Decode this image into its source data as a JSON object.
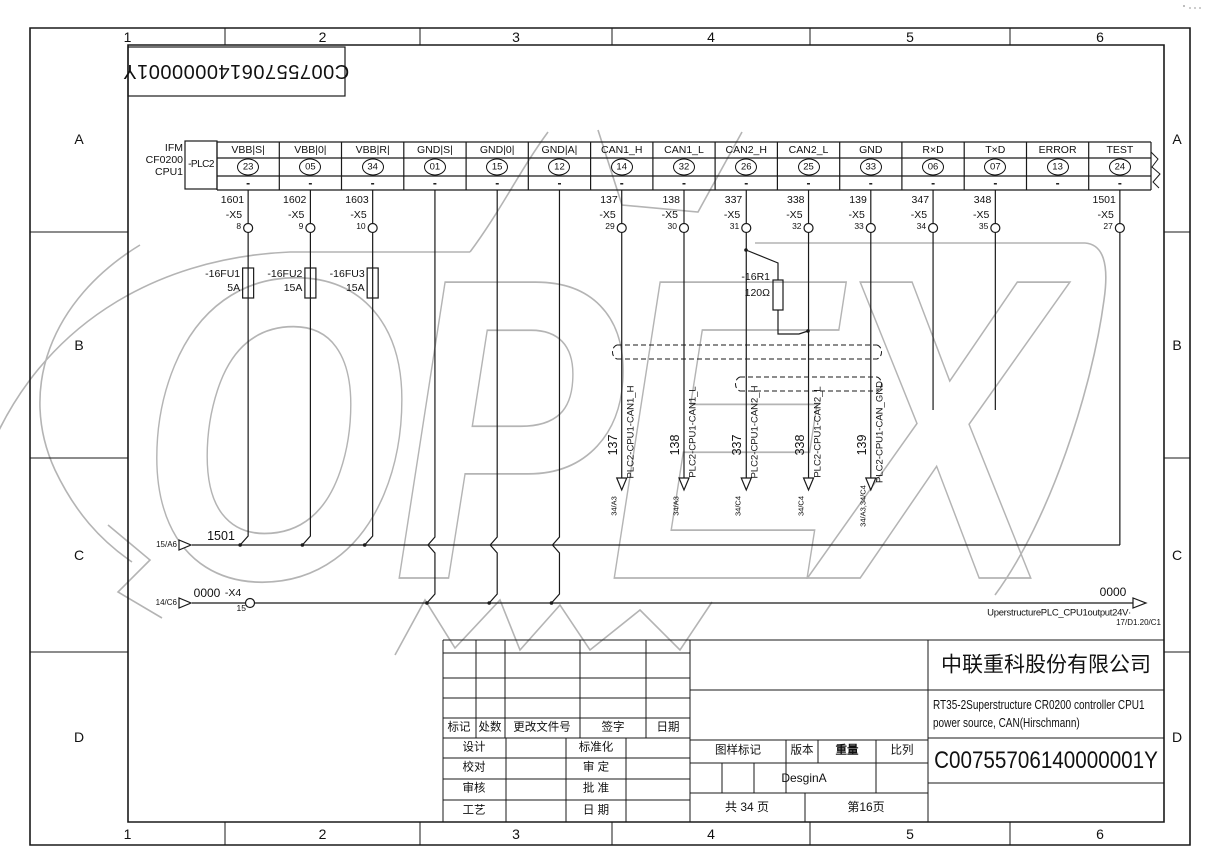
{
  "watermark": {
    "text": "OPEX"
  },
  "frame": {
    "columns": [
      "1",
      "2",
      "3",
      "4",
      "5",
      "6"
    ],
    "rows": [
      "A",
      "B",
      "C",
      "D"
    ]
  },
  "code_box": {
    "text": "C00755706140000001Y"
  },
  "plc": {
    "device_lines": [
      "IFM",
      "CF0200",
      "CPU1"
    ],
    "tag": "-PLC2",
    "connector_tag": "-X5",
    "terminal_dash": "-",
    "terminals": [
      {
        "label": "VBB|S|",
        "pin": "23",
        "wire": "1601",
        "x5_pin": "8",
        "fuse_tag": "-16FU1",
        "fuse_rating": "5A",
        "dest": "bus1501"
      },
      {
        "label": "VBB|0|",
        "pin": "05",
        "wire": "1602",
        "x5_pin": "9",
        "fuse_tag": "-16FU2",
        "fuse_rating": "15A",
        "dest": "bus1501"
      },
      {
        "label": "VBB|R|",
        "pin": "34",
        "wire": "1603",
        "x5_pin": "10",
        "fuse_tag": "-16FU3",
        "fuse_rating": "15A",
        "dest": "bus1501"
      },
      {
        "label": "GND|S|",
        "pin": "01",
        "dest": "bus0000"
      },
      {
        "label": "GND|0|",
        "pin": "15",
        "dest": "bus0000"
      },
      {
        "label": "GND|A|",
        "pin": "12",
        "dest": "bus0000"
      },
      {
        "label": "CAN1_H",
        "pin": "14",
        "wire": "137",
        "x5_pin": "29",
        "signal": "PLC2-CPU1-CAN1_H",
        "ref": "34/A3",
        "dest": "arrow"
      },
      {
        "label": "CAN1_L",
        "pin": "32",
        "wire": "138",
        "x5_pin": "30",
        "signal": "PLC2-CPU1-CAN1_L",
        "ref": "34/A3",
        "dest": "arrow"
      },
      {
        "label": "CAN2_H",
        "pin": "26",
        "wire": "337",
        "x5_pin": "31",
        "signal": "PLC2-CPU1-CAN2_H",
        "ref": "34/C4",
        "dest": "arrow"
      },
      {
        "label": "CAN2_L",
        "pin": "25",
        "wire": "338",
        "x5_pin": "32",
        "signal": "PLC2-CPU1-CAN2_L",
        "ref": "34/C4",
        "dest": "arrow"
      },
      {
        "label": "GND",
        "pin": "33",
        "wire": "139",
        "x5_pin": "33",
        "signal": "PLC2-CPU1-CAN_GND",
        "ref": "34/A3,34/C4",
        "dest": "arrow"
      },
      {
        "label": "R×D",
        "pin": "06",
        "wire": "347",
        "x5_pin": "34",
        "dest": "stub"
      },
      {
        "label": "T×D",
        "pin": "07",
        "wire": "348",
        "x5_pin": "35",
        "dest": "stub"
      },
      {
        "label": "ERROR",
        "pin": "13",
        "dest": "none"
      },
      {
        "label": "TEST",
        "pin": "24",
        "wire": "1501",
        "x5_pin": "27",
        "dest": "bus1501_direct"
      }
    ]
  },
  "resistor": {
    "tag": "-16R1",
    "value": "120Ω"
  },
  "bus_1501": {
    "label": "1501",
    "source_ref": "15/A6"
  },
  "bus_0000": {
    "label": "0000",
    "source_ref": "14/C6",
    "connector": "-X4",
    "pin": "15",
    "dest_label": "0000",
    "dest_name": "UperstructurePLC_CPU1output24V·",
    "dest_ref": "17/D1.20/C1"
  },
  "title_block": {
    "company": "中联重科股份有限公司",
    "description_line1": "RT35-2Superstructure CR0200 controller CPU1",
    "description_line2": "power source, CAN(Hirschmann)",
    "drawing_number": "C00755706140000001Y",
    "rev_header": {
      "mark": "标记",
      "count": "处数",
      "change_doc": "更改文件号",
      "signature": "签字",
      "date": "日期"
    },
    "roles": [
      [
        "设计",
        "标准化"
      ],
      [
        "校对",
        "审 定"
      ],
      [
        "审核",
        "批 准"
      ],
      [
        "工艺",
        "日 期"
      ]
    ],
    "stamp_header": {
      "stamp": "图样标记",
      "version": "版本",
      "weight": "重量",
      "scale": "比列"
    },
    "version_value": "DesginA",
    "pages_total": "共 34 页",
    "page_current": "第16页"
  }
}
